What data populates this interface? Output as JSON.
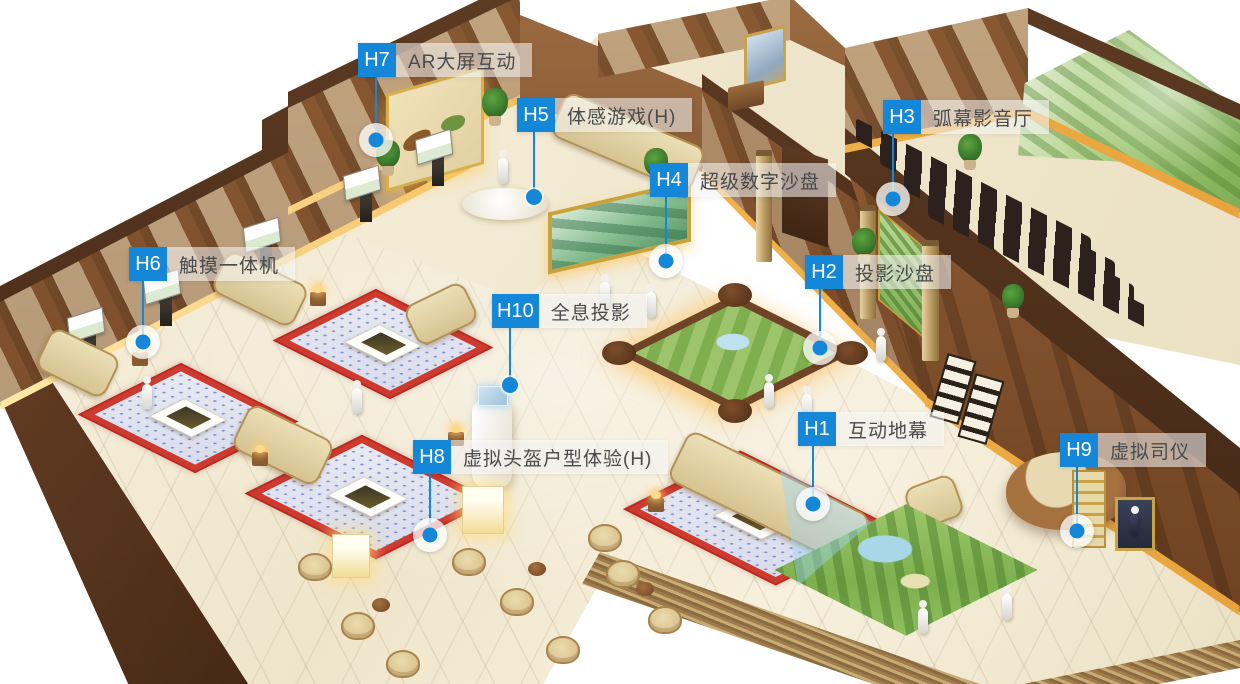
{
  "colors": {
    "accent": "#1587d8",
    "label_text": "#4a4a4a",
    "label_bg": "rgba(255,255,255,0.55)"
  },
  "hotspots": [
    {
      "id": "H1",
      "label": "互动地幕",
      "badge": {
        "x": 798,
        "y": 412
      },
      "marker": {
        "x": 813,
        "y": 504,
        "style": "halo"
      }
    },
    {
      "id": "H2",
      "label": "投影沙盘",
      "badge": {
        "x": 805,
        "y": 255
      },
      "marker": {
        "x": 820,
        "y": 348,
        "style": "halo"
      }
    },
    {
      "id": "H3",
      "label": "弧幕影音厅",
      "badge": {
        "x": 883,
        "y": 100
      },
      "marker": {
        "x": 893,
        "y": 199,
        "style": "halo"
      }
    },
    {
      "id": "H4",
      "label": "超级数字沙盘",
      "badge": {
        "x": 650,
        "y": 163
      },
      "marker": {
        "x": 666,
        "y": 261,
        "style": "halo"
      }
    },
    {
      "id": "H5",
      "label": "体感游戏(H)",
      "badge": {
        "x": 517,
        "y": 98
      },
      "marker": {
        "x": 534,
        "y": 197,
        "style": "dot"
      }
    },
    {
      "id": "H6",
      "label": "触摸一体机",
      "badge": {
        "x": 129,
        "y": 247
      },
      "marker": {
        "x": 143,
        "y": 342,
        "style": "halo"
      }
    },
    {
      "id": "H7",
      "label": "AR大屏互动",
      "badge": {
        "x": 358,
        "y": 43
      },
      "marker": {
        "x": 376,
        "y": 140,
        "style": "halo"
      }
    },
    {
      "id": "H8",
      "label": "虚拟头盔户型体验(H)",
      "badge": {
        "x": 413,
        "y": 440
      },
      "marker": {
        "x": 430,
        "y": 535,
        "style": "halo"
      }
    },
    {
      "id": "H9",
      "label": "虚拟司仪",
      "badge": {
        "x": 1060,
        "y": 433
      },
      "marker": {
        "x": 1077,
        "y": 531,
        "style": "halo"
      }
    },
    {
      "id": "H10",
      "label": "全息投影",
      "badge": {
        "x": 492,
        "y": 294
      },
      "marker": {
        "x": 510,
        "y": 385,
        "style": "dot"
      }
    }
  ]
}
